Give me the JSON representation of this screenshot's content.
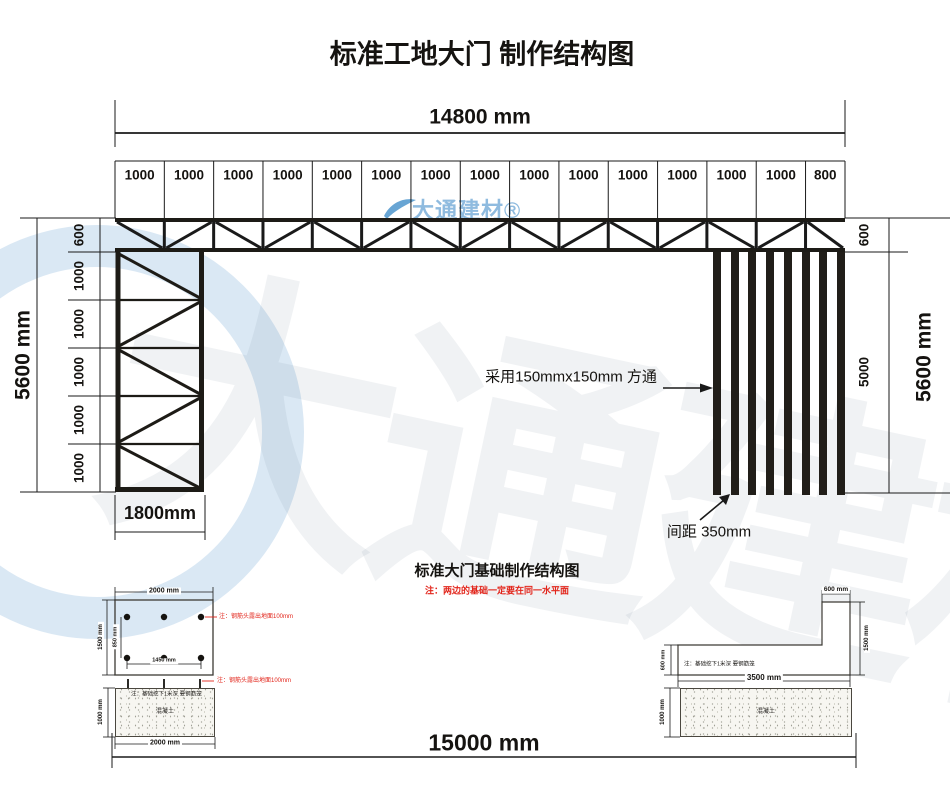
{
  "title": "标准工地大门 制作结构图",
  "watermark": {
    "small": "大通建材®",
    "large": "大通建材"
  },
  "gate": {
    "total_width": "14800 mm",
    "top_segments": [
      "1000",
      "1000",
      "1000",
      "1000",
      "1000",
      "1000",
      "1000",
      "1000",
      "1000",
      "1000",
      "1000",
      "1000",
      "1000",
      "1000",
      "800"
    ],
    "left_total": "5600 mm",
    "left_segments": [
      "600",
      "1000",
      "1000",
      "1000",
      "1000",
      "1000"
    ],
    "right_top": "600",
    "right_mid": "5000",
    "right_total": "5600 mm",
    "column_width": "1800mm",
    "tube_note": "采用150mmx150mm 方通",
    "spacing_note": "间距 350mm"
  },
  "foundation": {
    "title": "标准大门基础制作结构图",
    "level_note": "注：两边的基础一定要在同一水平面",
    "plan": {
      "width": "2000 mm",
      "height": "1500 mm",
      "row_gap": "850 mm",
      "col_gap": "1450 mm",
      "rebar_note": "注：钢筋头露出地面100mm"
    },
    "left_section": {
      "rebar_note": "注：钢筋头露出地面100mm",
      "depth_note": "注：基础挖下1米深 要钢筋笼",
      "height": "1000 mm",
      "width": "2000 mm",
      "material": "混凝土"
    },
    "right_section": {
      "top_width": "600 mm",
      "right_height": "1500 mm",
      "left_height": "600 mm",
      "depth_note": "注：基础挖下1米深 要钢筋笼",
      "bottom_width": "3500 mm",
      "height": "1000 mm",
      "material": "混凝土"
    },
    "overall_width": "15000 mm"
  },
  "colors": {
    "line": "#1a1a1a",
    "red": "#e2251b",
    "watermark_blue": "#8fbbdf"
  }
}
